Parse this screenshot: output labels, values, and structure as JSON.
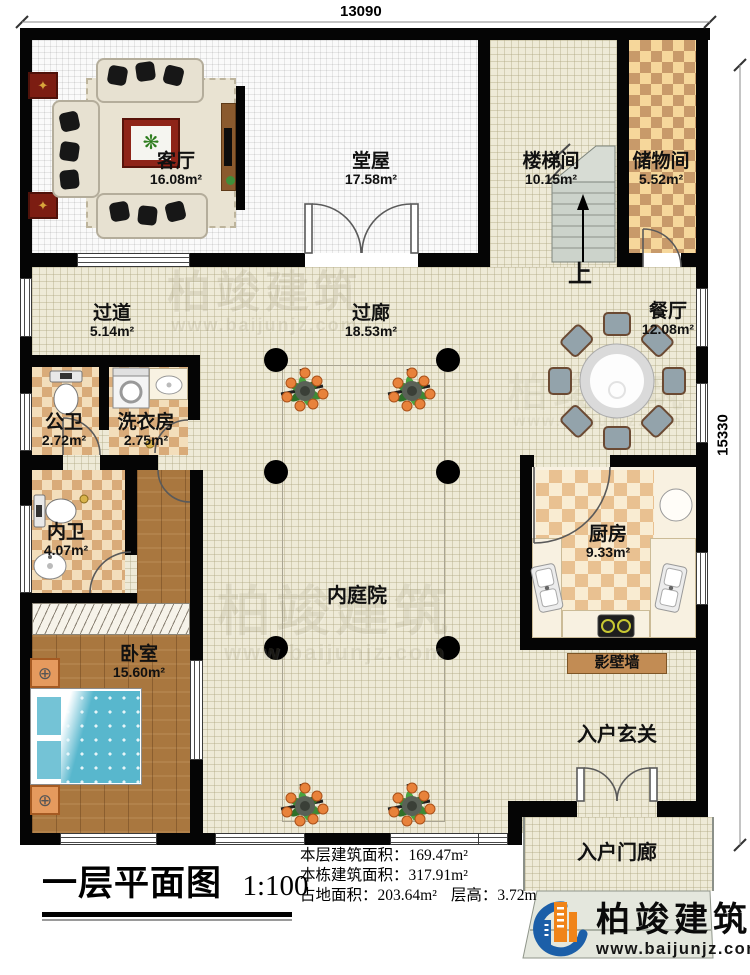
{
  "title": {
    "text": "一层平面图",
    "scale": "1:100"
  },
  "stats": {
    "line1_label": "本层建筑面积：",
    "line1_value": "169.47m²",
    "line2_label": "本栋建筑面积：",
    "line2_value": "317.91m²",
    "line3_label": "占地面积：",
    "line3_value": "203.64m²",
    "line3b_label": "层高：",
    "line3b_value": "3.72m"
  },
  "dims": {
    "top": "13090",
    "right": "15330"
  },
  "rooms": {
    "living": {
      "name": "客厅",
      "area": "16.08m²"
    },
    "hall": {
      "name": "堂屋",
      "area": "17.58m²"
    },
    "stairwell": {
      "name": "楼梯间",
      "area": "10.15m²"
    },
    "storage": {
      "name": "储物间",
      "area": "5.52m²"
    },
    "passage": {
      "name": "过道",
      "area": "5.14m²"
    },
    "corridor": {
      "name": "过廊",
      "area": "18.53m²"
    },
    "dining": {
      "name": "餐厅",
      "area": "12.08m²"
    },
    "pubbath": {
      "name": "公卫",
      "area": "2.72m²"
    },
    "laundry": {
      "name": "洗衣房",
      "area": "2.75m²"
    },
    "bath": {
      "name": "内卫",
      "area": "4.07m²"
    },
    "kitchen": {
      "name": "厨房",
      "area": "9.33m²"
    },
    "courtyard": {
      "name": "内庭院"
    },
    "bedroom": {
      "name": "卧室",
      "area": "15.60m²"
    },
    "screenwall": {
      "name": "影壁墙"
    },
    "foyer": {
      "name": "入户玄关"
    },
    "porch": {
      "name": "入户门廊"
    }
  },
  "stairs": {
    "up": "上"
  },
  "brand": {
    "name": "柏竣建筑",
    "url": "www.baijunjz.com"
  },
  "icons": {
    "diamond": "✦",
    "plant": "❋",
    "vent": "⊕"
  },
  "colors": {
    "wall": "#050505",
    "floor_tan": "#eeead7",
    "floor_white": "#fafafa",
    "wood": "#a9773f",
    "bed": "#58b7cd",
    "logo_blue": "#1c5fa8",
    "logo_orange": "#f08419",
    "screen_wall": "#c28c54"
  }
}
